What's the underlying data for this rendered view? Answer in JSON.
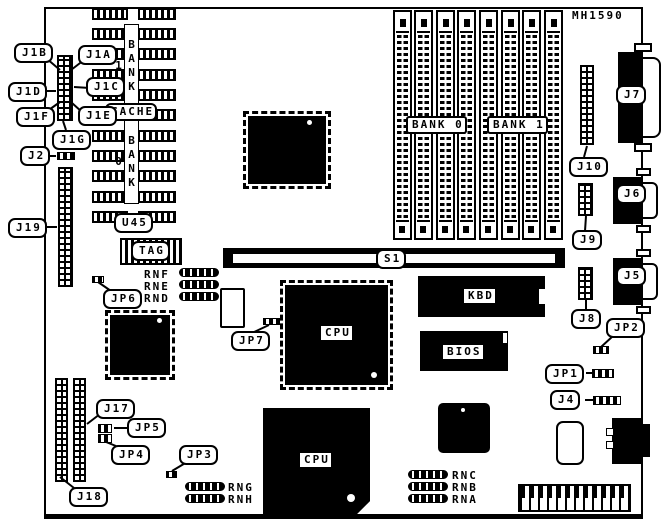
{
  "board": {
    "part_number": "MH1590"
  },
  "callouts": {
    "j1b": "J1B",
    "j1a": "J1A",
    "j1d": "J1D",
    "j1c": "J1C",
    "j1f": "J1F",
    "j1e": "J1E",
    "j1g": "J1G",
    "j2": "J2",
    "j19": "J19",
    "jp6": "JP6",
    "jp7": "JP7",
    "j17": "J17",
    "jp5": "JP5",
    "jp4": "JP4",
    "j18": "J18",
    "jp3": "JP3",
    "j10": "J10",
    "j9": "J9",
    "j8": "J8",
    "jp2": "JP2",
    "jp1": "JP1",
    "j4": "J4",
    "j7": "J7",
    "j6": "J6",
    "j5": "J5",
    "s1": "S1"
  },
  "chips": {
    "cpu_qfp": "CPU",
    "cpu_socket": "CPU",
    "kbd": "KBD",
    "bios": "BIOS",
    "cache": "CACHE",
    "u45": "U45",
    "tag": "TAG",
    "bank0_simm": "BANK 0",
    "bank1_simm": "BANK 1",
    "bank1_dip": "BANK 1",
    "bank0_dip": "BANK 0"
  },
  "resistor_networks": {
    "rnf": "RNF",
    "rne": "RNE",
    "rnd": "RND",
    "rng": "RNG",
    "rnh": "RNH",
    "rnc": "RNC",
    "rnb": "RNB",
    "rna": "RNA"
  }
}
